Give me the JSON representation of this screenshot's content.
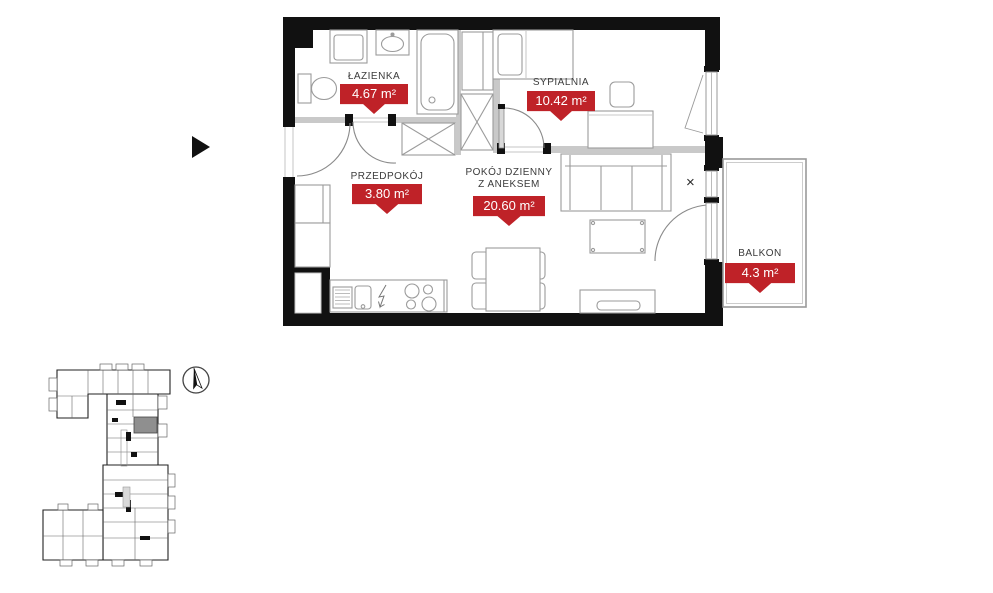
{
  "rooms": [
    {
      "name": "ŁAZIENKA",
      "area": "4.67 m²"
    },
    {
      "name": "SYPIALNIA",
      "area": "10.42 m²"
    },
    {
      "name": "PRZEDPOKÓJ",
      "area": "3.80 m²"
    },
    {
      "name": "POKÓJ DZIENNY",
      "name_line2": "Z ANEKSEM",
      "area": "20.60 m²"
    },
    {
      "name": "BALKON",
      "area": "4.3 m²"
    }
  ],
  "markers": {
    "window_cross": "×"
  },
  "colors": {
    "tag_red": "#bf2228",
    "wall_black": "#111111",
    "partition_gray": "#c9c9c9",
    "furniture_gray": "#9b9b9b",
    "label_gray": "#3b3b3b",
    "minimap_highlight": "#8f8f8f"
  }
}
